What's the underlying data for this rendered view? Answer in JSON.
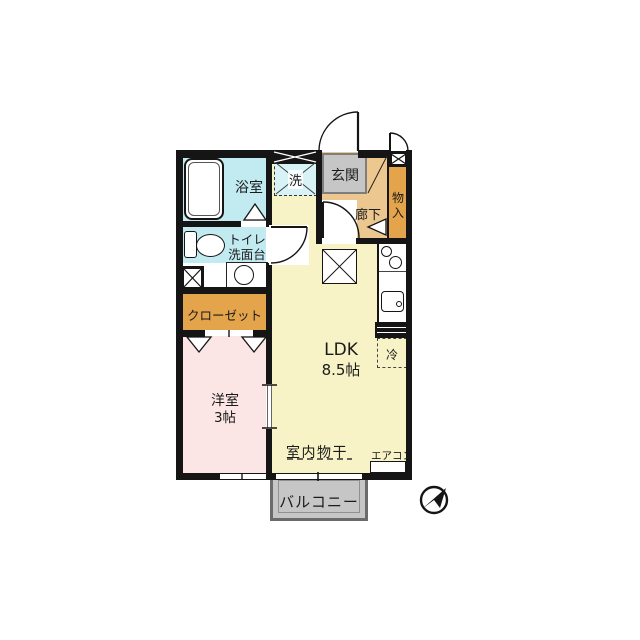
{
  "floorplan": {
    "rooms": {
      "bathroom": {
        "label": "浴室"
      },
      "laundry": {
        "label": "洗"
      },
      "entrance": {
        "label": "玄関"
      },
      "hallway": {
        "label": "廊下"
      },
      "storage": {
        "label": "物入"
      },
      "toilet_vanity": {
        "label_line1": "トイレ",
        "label_line2": "洗面台"
      },
      "closet": {
        "label": "クローゼット"
      },
      "western_room": {
        "label": "洋室",
        "size": "3帖"
      },
      "ldk": {
        "label": "LDK",
        "size": "8.5帖"
      },
      "refrigerator": {
        "label": "冷"
      },
      "balcony": {
        "label": "バルコニー"
      }
    },
    "annotations": {
      "indoor_drying": {
        "label": "室内物干"
      },
      "aircon": {
        "label": "エアコン"
      }
    },
    "icons": {
      "compass": "north-arrow-icon"
    },
    "colors": {
      "bathroom": "#c2eaf1",
      "laundry": "#d8f3f6",
      "entrance_floor": "#c6c6c6",
      "hallway": "#ecc890",
      "storage": "#e3a44c",
      "closet": "#e3a44c",
      "western_room": "#fbe5e5",
      "ldk": "#f7f3c6",
      "balcony": "#c6c6c6",
      "wall": "#151515",
      "background": "#ffffff"
    }
  }
}
